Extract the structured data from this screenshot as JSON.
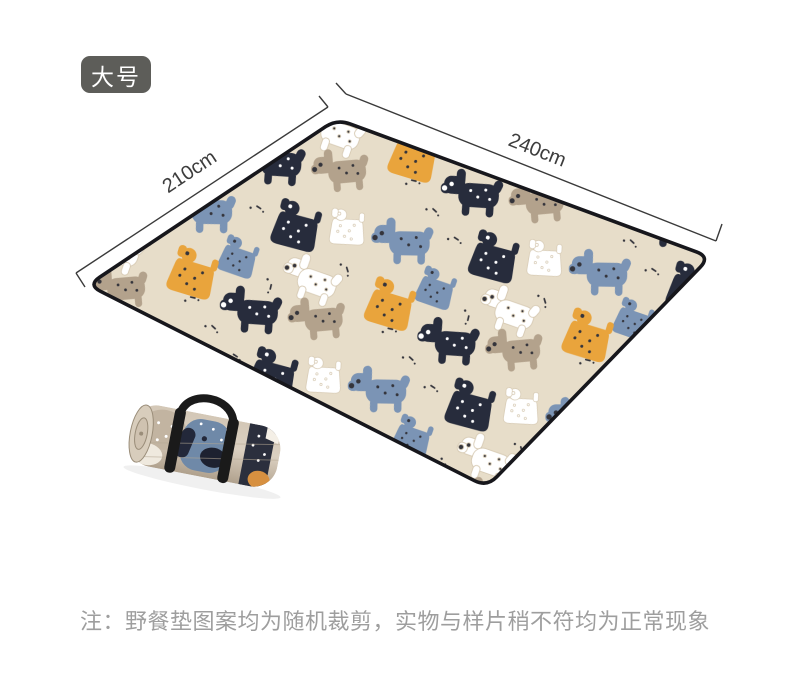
{
  "badge": {
    "label": "大号"
  },
  "dimensions": {
    "width_label": "240cm",
    "depth_label": "210cm"
  },
  "note": {
    "text": "注：野餐垫图案均为随机裁剪，实物与样片稍不符均为正常现象"
  },
  "illustrations": {
    "mat": "picnic-mat-cartoon-dog-pattern",
    "roll": "rolled-picnic-mat-with-black-carry-strap"
  },
  "colors": {
    "badge_bg": "#5d5d59",
    "badge_text": "#ffffff",
    "mat_base": "#e7ddc9",
    "mat_border": "#17171c",
    "dog_navy": "#272c3c",
    "dog_blue": "#7b94b5",
    "dog_mustard": "#e9a43c",
    "dog_white": "#ffffff",
    "dog_tan": "#b3a28c",
    "speckle": "#34343b",
    "dim_line": "#3a3a3a",
    "note_text": "#9e9e9e",
    "strap_black": "#1a1a1a"
  }
}
